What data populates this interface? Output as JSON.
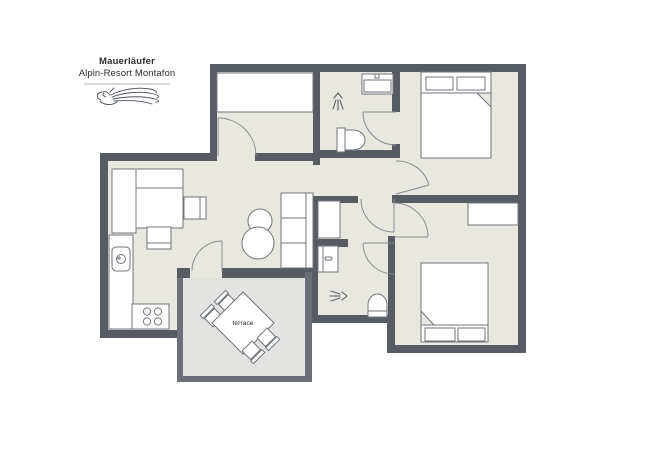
{
  "logo": {
    "line1": "Mauerläufer",
    "line2": "Alpin-Resort Montafon",
    "art_icon": "wallcreeper-bird-line-art"
  },
  "plan": {
    "terrace_label": "terrace"
  },
  "icons": {
    "shower": "spray-fan-glyph",
    "bird": "wallcreeper-line-art"
  },
  "colors": {
    "wall": "#575c63",
    "terrace_wall": "#6b7077",
    "floor": "#e9e8e0",
    "terrace_floor": "#e3e3e1",
    "furniture_fill": "#ffffff",
    "furniture_stroke": "#70757c",
    "door_stroke": "#898d93",
    "icon_stroke": "#5c6168",
    "logo_art": "#4d525a",
    "divider": "#b0b3b6",
    "text": "#2e2e2e",
    "background": "#ffffff"
  }
}
